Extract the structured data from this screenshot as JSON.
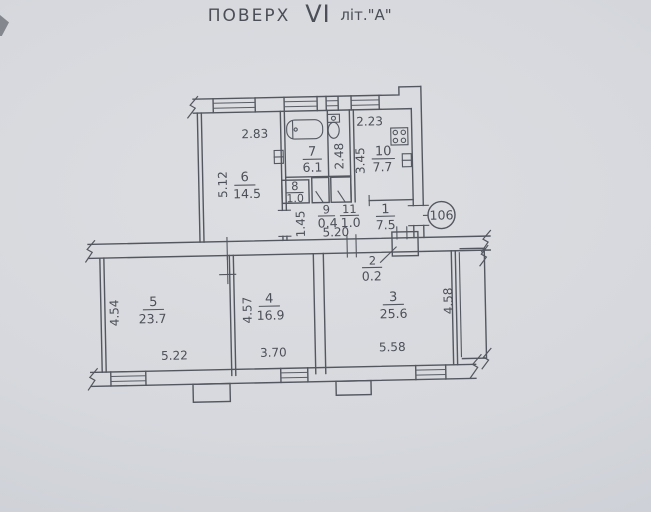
{
  "title": {
    "word": "ПОВЕРХ",
    "floor": "VI",
    "lit": "літ.\"А\""
  },
  "badge": {
    "apartment": "106"
  },
  "rooms": {
    "r1": {
      "number": "1",
      "area": "7.5"
    },
    "r2": {
      "number": "2",
      "area": "0.2"
    },
    "r3": {
      "number": "3",
      "area": "25.6"
    },
    "r4": {
      "number": "4",
      "area": "16.9"
    },
    "r5": {
      "number": "5",
      "area": "23.7"
    },
    "r6": {
      "number": "6",
      "area": "14.5"
    },
    "r7": {
      "number": "7",
      "area": "6.1"
    },
    "r8": {
      "number": "8",
      "area": "1.0"
    },
    "r9": {
      "number": "9",
      "area": "0.4"
    },
    "r10": {
      "number": "10",
      "area": "7.7"
    },
    "r11": {
      "number": "11",
      "area": "1.0"
    }
  },
  "dims": {
    "room6_w": "2.83",
    "room6_h": "5.12",
    "wc_h": "2.48",
    "kitchen_w": "2.23",
    "kitchen_h": "3.45",
    "hall_w": "1.45",
    "hall_l": "5.20",
    "room5_h": "4.54",
    "room5_w": "5.22",
    "room4_h": "4.57",
    "room4_w": "3.70",
    "room3_h": "4.58",
    "room3_w": "5.58"
  },
  "icons": {
    "bathtub": "bathtub-icon",
    "toilet": "toilet-icon",
    "stove": "stove-icon",
    "radiator": "radiator-icon"
  },
  "colors": {
    "paper": "#d6d8dd",
    "ink": "#54575f"
  }
}
